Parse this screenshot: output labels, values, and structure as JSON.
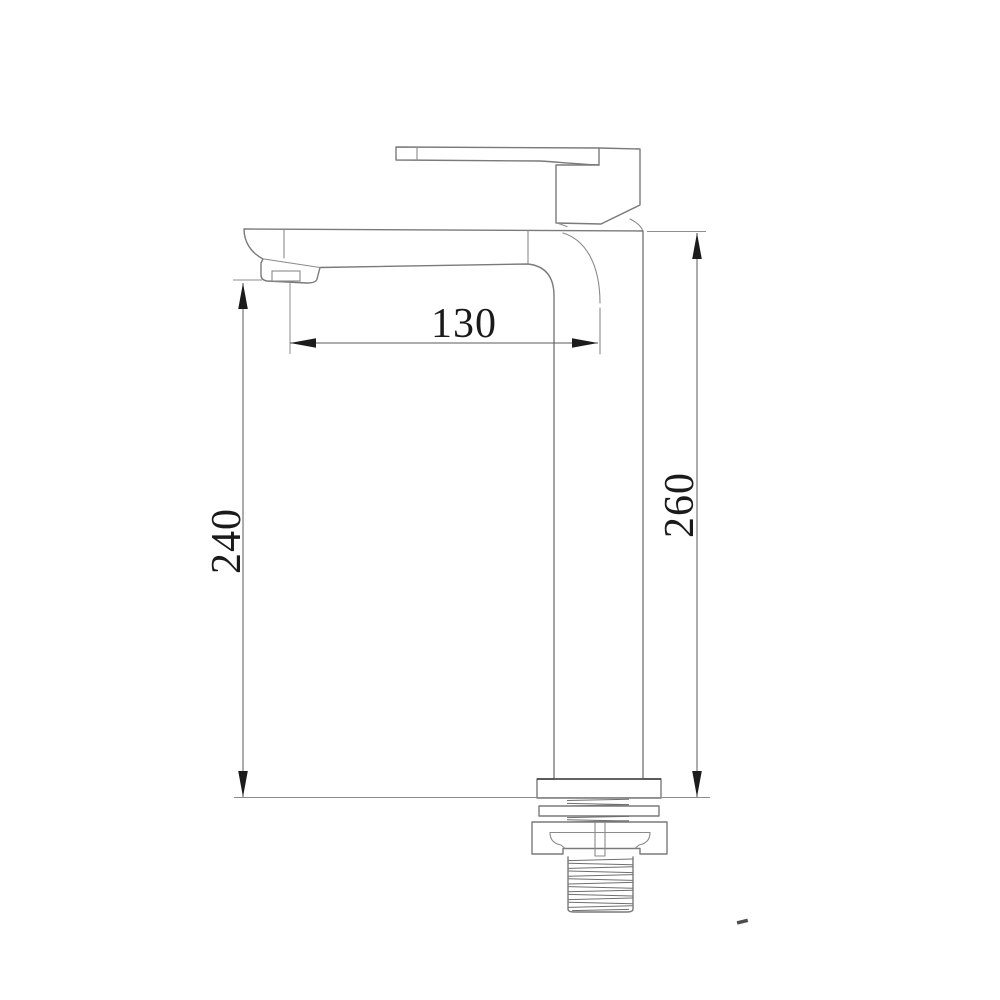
{
  "drawing": {
    "type": "technical-dimension-drawing",
    "subject": "tall single-lever basin mixer faucet, side elevation",
    "labels": {
      "spout_reach": "130",
      "height_to_spout_outlet": "240",
      "overall_height": "260"
    }
  },
  "colors": {
    "background": "#ffffff",
    "outline": "#7a7a7a",
    "dimension_line": "#585858",
    "arrow_and_text": "#1a1a1a"
  }
}
